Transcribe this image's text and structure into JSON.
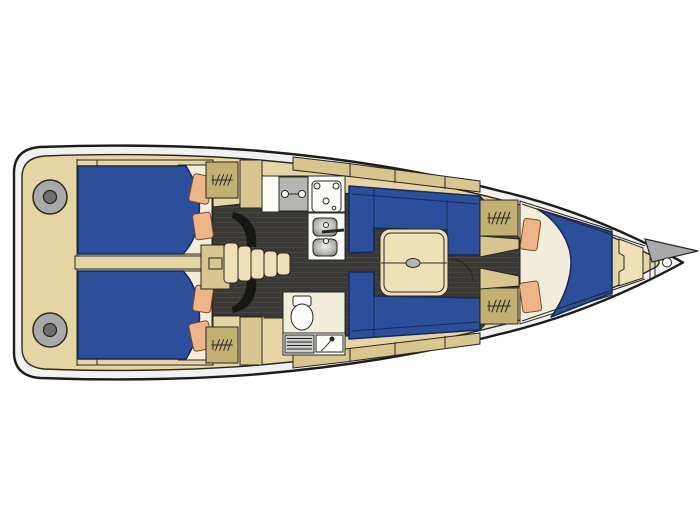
{
  "meta": {
    "type": "yacht-interior-deck-plan",
    "subject": "sailing yacht top-down interior layout, bow pointing right",
    "visible_text": "none"
  },
  "palette": {
    "bg": "#ffffff",
    "hull_band": "#f1f1ef",
    "hull_stroke": "#1c1c1c",
    "line": "#2a2722",
    "deck_tan": "#e5d5a4",
    "tan_mid": "#d8c58f",
    "tan_dark": "#c3b173",
    "tan_light": "#eee1b8",
    "berth_blue": "#2c4e9b",
    "blue_stroke": "#17295c",
    "cream": "#f2eedb",
    "peach": "#eeb58b",
    "peach_stroke": "#7c4a26",
    "floor_dark": "#3b3935",
    "floor_stripe": "#474540",
    "door_dark": "#161614",
    "fixture_white": "#fbfbf8",
    "fixture_gray": "#b5b5b3",
    "winch_gray": "#a9a9a9",
    "winch_hub": "#6f6f6f",
    "oval_gray": "#b3b7ad",
    "grate_gray": "#cccccc"
  },
  "parts": [
    {
      "name": "hull-outline",
      "desc": "boat hull, squared stern left, pointed bow right"
    },
    {
      "name": "cockpit-winch-port",
      "desc": "round deck winch, stern port side"
    },
    {
      "name": "cockpit-winch-starboard",
      "desc": "round deck winch, stern starboard side"
    },
    {
      "name": "aft-cabin-port-berth",
      "desc": "blue double berth with sheet and 2 pillows"
    },
    {
      "name": "aft-cabin-starboard-berth",
      "desc": "blue double berth with sheet and 2 pillows"
    },
    {
      "name": "companionway-steps",
      "desc": "entry steps between aft cabins"
    },
    {
      "name": "galley",
      "desc": "port-side galley: cooktop, stove, double sink with faucet"
    },
    {
      "name": "head",
      "desc": "starboard-side head: toilet, shower grate, washbasin with faucet"
    },
    {
      "name": "salon-settee-port",
      "desc": "blue L-shaped settee"
    },
    {
      "name": "salon-settee-starboard",
      "desc": "blue settee"
    },
    {
      "name": "salon-table",
      "desc": "folding table with center handle oval"
    },
    {
      "name": "hanging-lockers",
      "desc": "4 wardrobe lockers marked with hanger-rail symbol"
    },
    {
      "name": "forward-v-berth",
      "desc": "blue V-berth with folded sheet and 2 pillows"
    },
    {
      "name": "anchor-locker",
      "desc": "bow stowage panel"
    },
    {
      "name": "bow-roller-platform",
      "desc": "gray anchor roller wedge at bow tip"
    },
    {
      "name": "bow-fitting",
      "desc": "small round deck fitting at bow"
    },
    {
      "name": "cabin-sole",
      "desc": "dark walkway floor with plank stripes"
    },
    {
      "name": "door-swings",
      "desc": "dark door-swing arcs at aft cabins and forward cabin"
    }
  ],
  "pillow_count": 6,
  "locker_count": 4,
  "winch_count": 2
}
